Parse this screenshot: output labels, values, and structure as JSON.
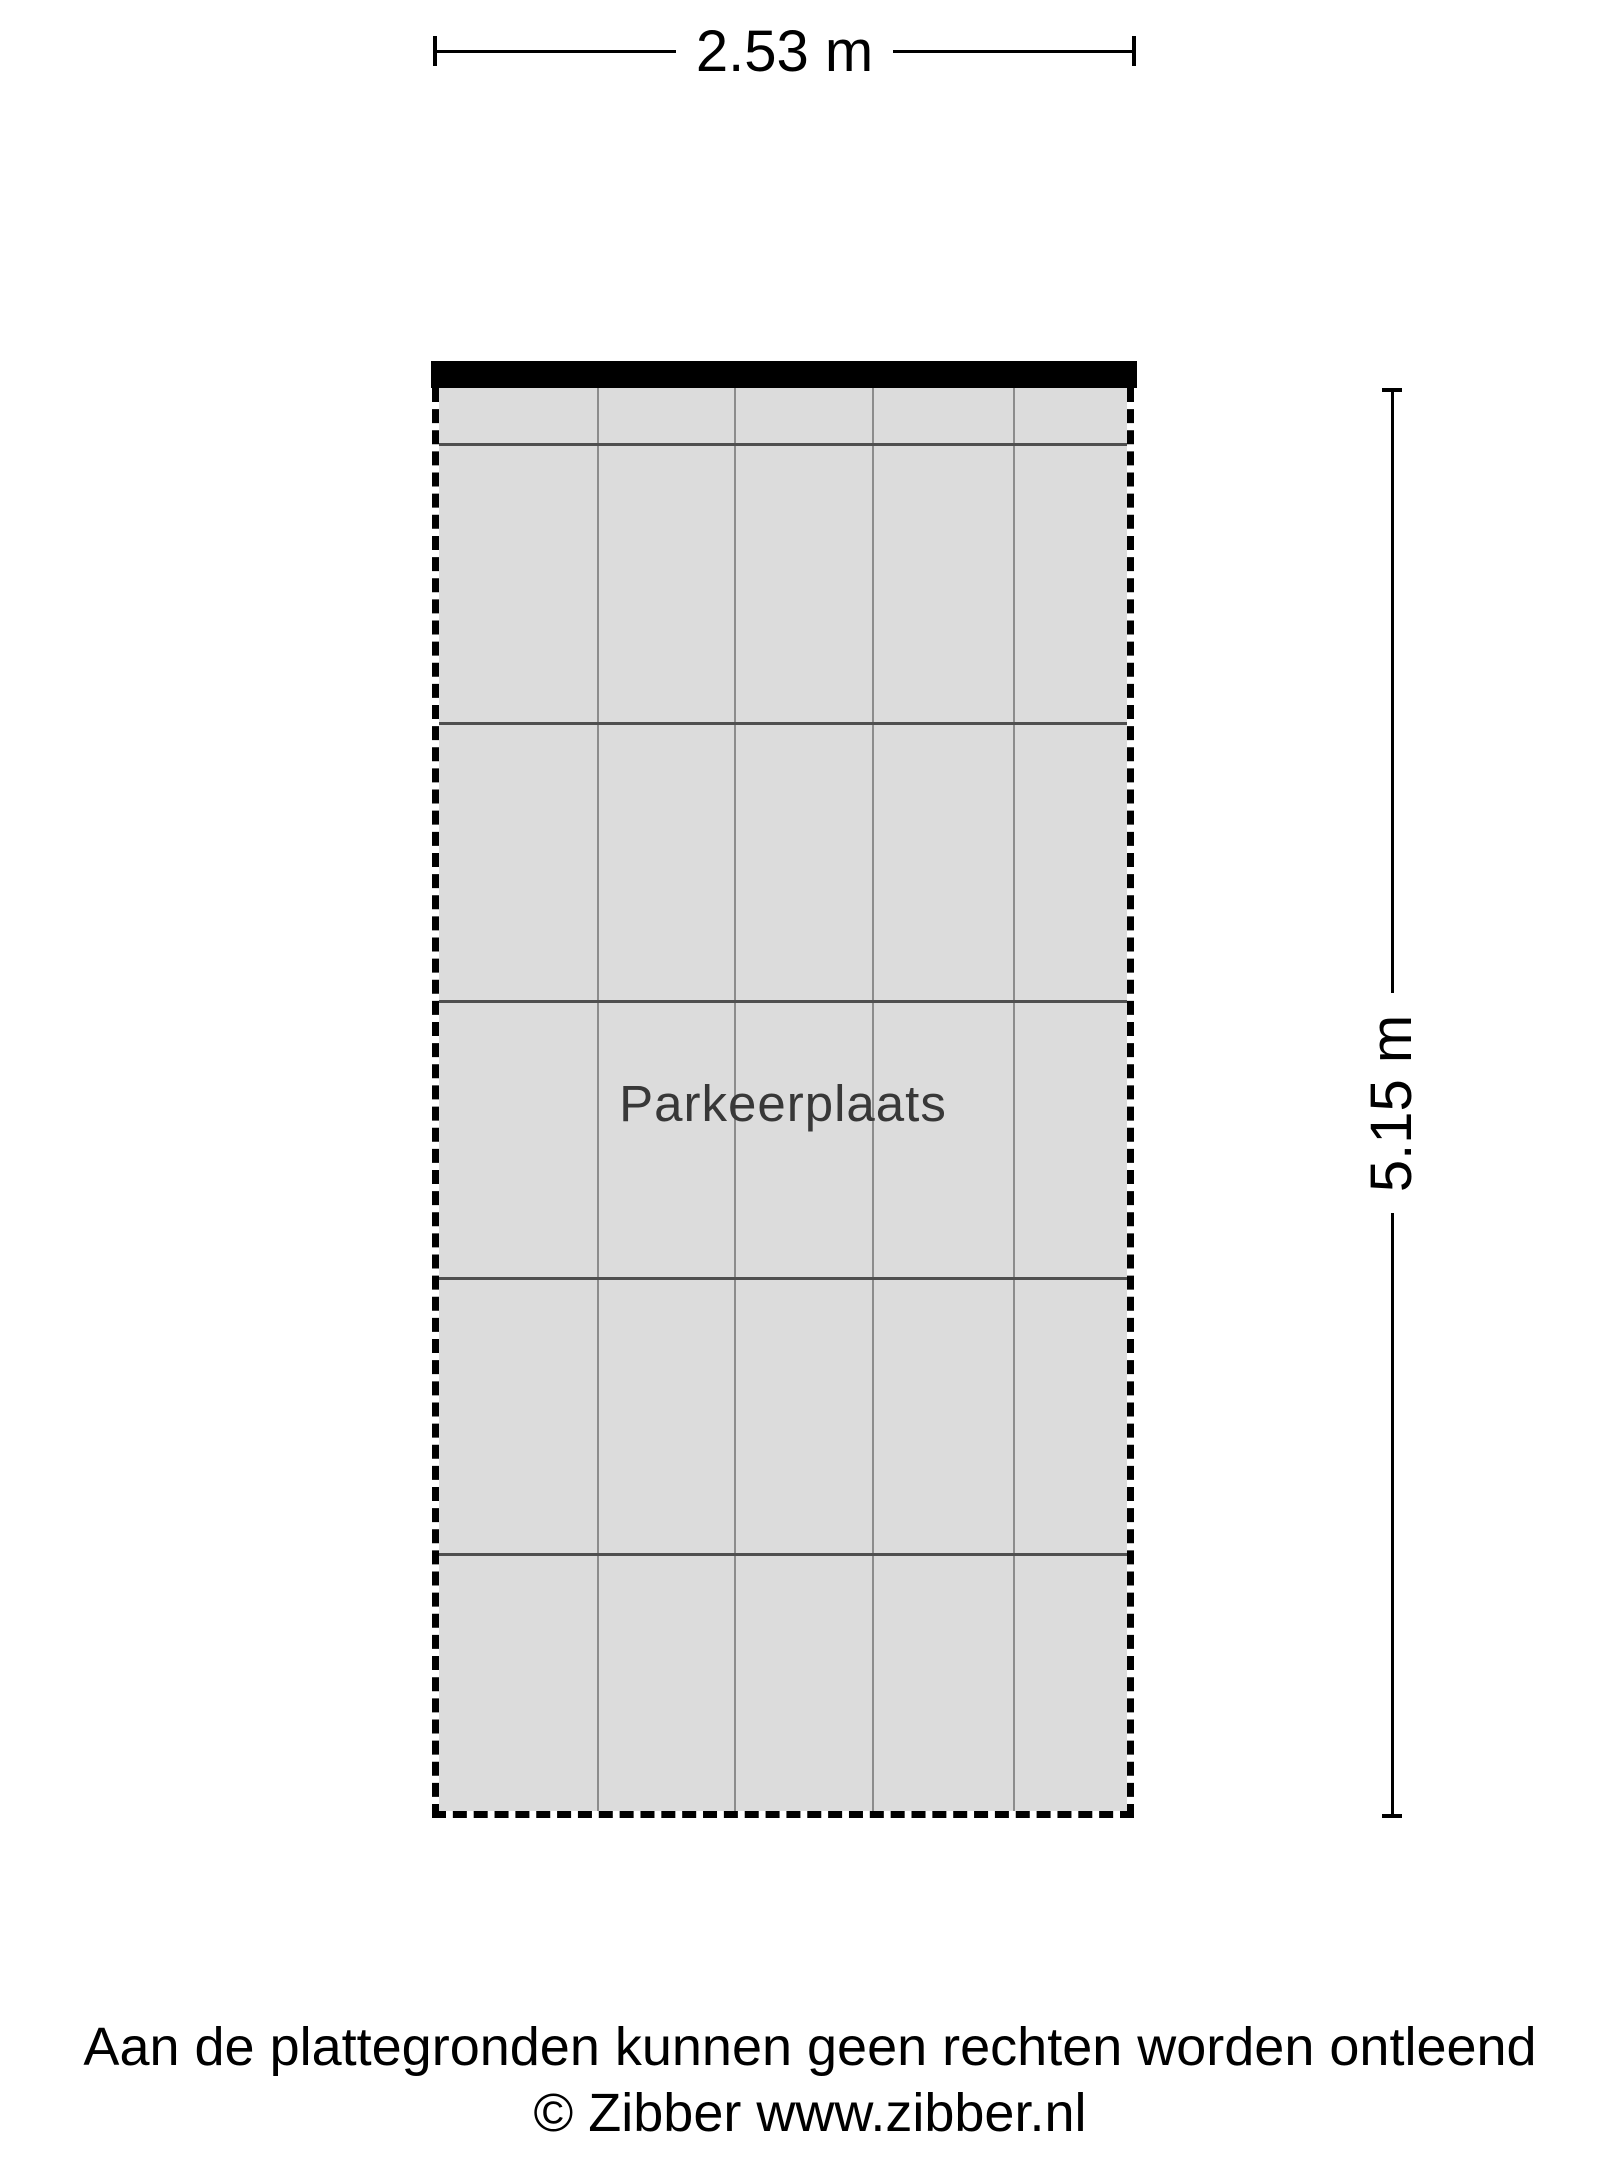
{
  "plan": {
    "room_label": "Parkeerplaats",
    "width_dim": {
      "label": "2.53 m"
    },
    "height_dim": {
      "label": "5.15 m"
    },
    "colors": {
      "page_bg": "#ffffff",
      "floor_fill": "#dcdcdc",
      "wall": "#000000",
      "grid_line_horizontal": "#4f4f4f",
      "grid_line_vertical": "#8c8c8c",
      "room_label_text": "#383838",
      "dim_text": "#000000"
    },
    "tile_grid": {
      "vertical_x": [
        158,
        295,
        433,
        574
      ],
      "horizontal_y": [
        55,
        334,
        612,
        889,
        1165
      ]
    }
  },
  "footer": {
    "line1": "Aan de plattegronden kunnen geen rechten worden ontleend",
    "line2": "© Zibber www.zibber.nl"
  }
}
